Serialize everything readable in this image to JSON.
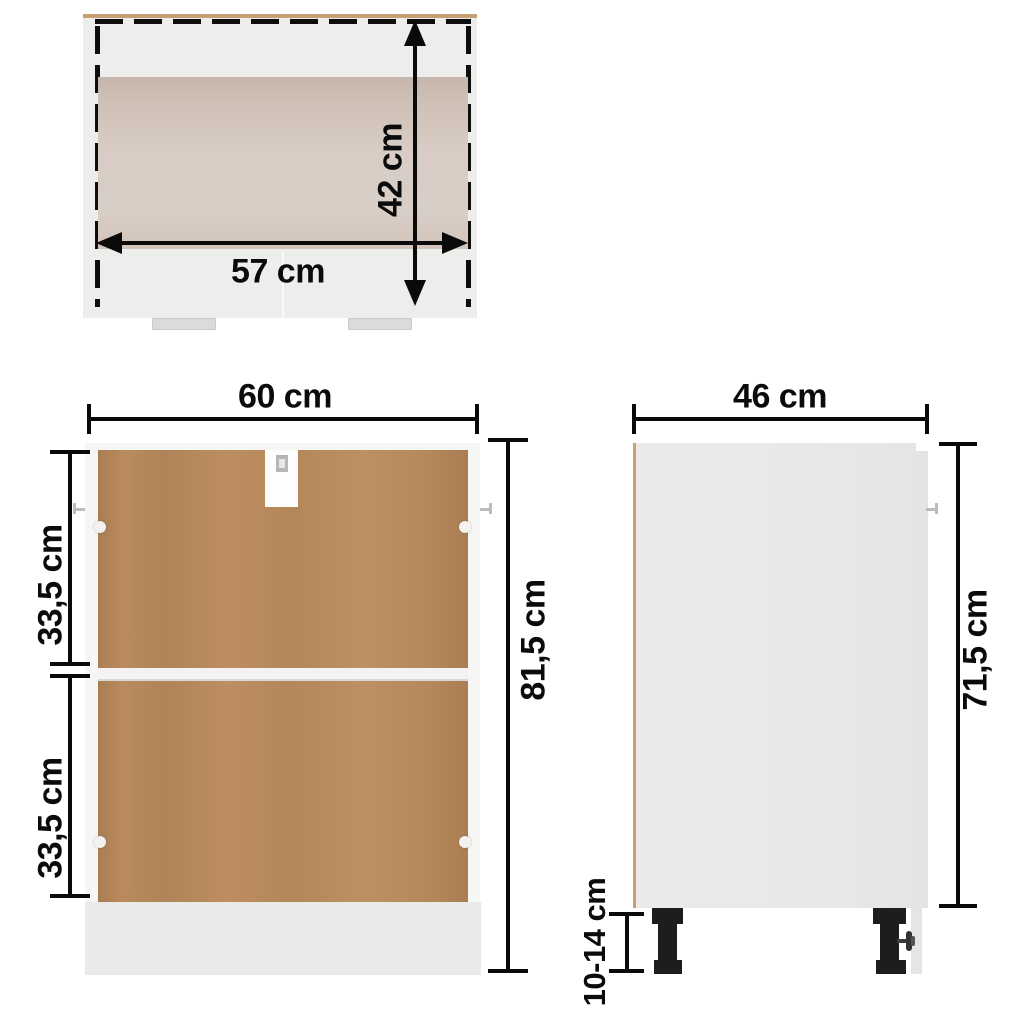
{
  "diagram": {
    "top_view": {
      "width_label": "57 cm",
      "depth_label": "42 cm"
    },
    "front_view": {
      "width_label": "60 cm",
      "upper_section_label": "33,5 cm",
      "lower_section_label": "33,5 cm",
      "height_label": "81,5 cm"
    },
    "side_view": {
      "depth_label": "46 cm",
      "height_label": "71,5 cm",
      "leg_height_label": "10-14 cm"
    },
    "colors": {
      "dimension_black": "#0a0a0a",
      "back_panel_brown": "#b78a5e",
      "wood_edge_tan": "#c79f72",
      "interior_tan": "#d5c8bf",
      "body_gray": "#e9e8e7",
      "plinth_gray": "#ebeae9",
      "leg_black": "#1d1d1d"
    }
  }
}
